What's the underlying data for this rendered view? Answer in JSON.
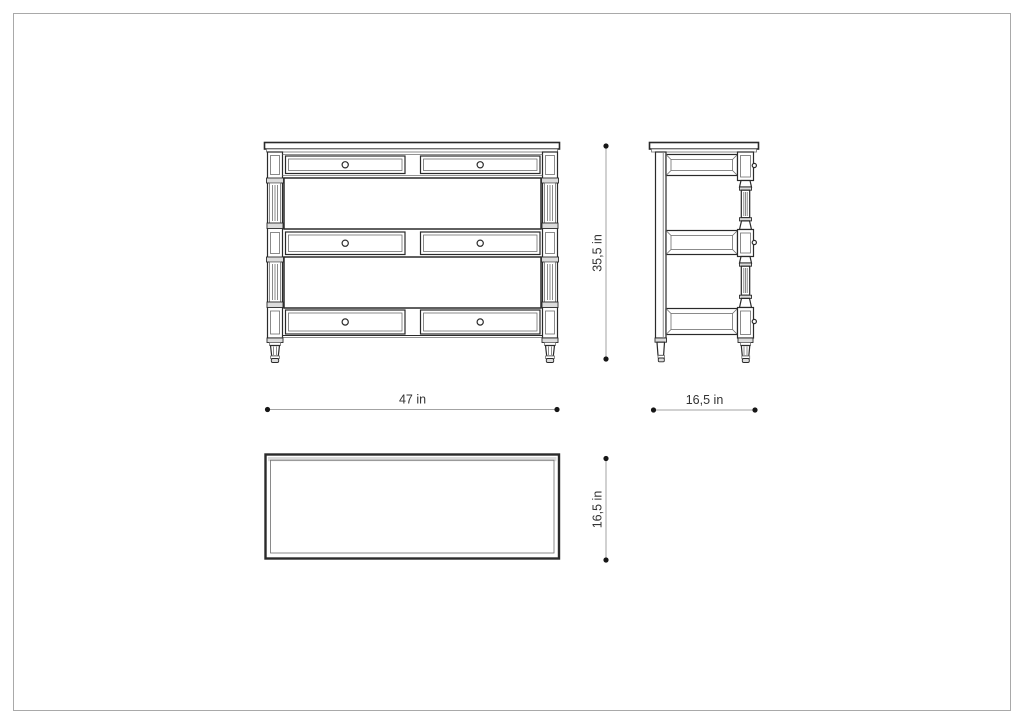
{
  "page": {
    "background": "#ffffff",
    "border_color": "#a9a9a9"
  },
  "dimensions": {
    "height": "35,5 in",
    "width": "47 in",
    "depth_side": "16,5 in",
    "depth_top": "16,5 in"
  },
  "colors": {
    "outline": "#2a2a2a",
    "detail": "#6e6e6e",
    "shade": "#dcdcdc",
    "dim_line": "#a3a3a3",
    "dim_dot": "#161616",
    "dim_text": "#333333"
  }
}
